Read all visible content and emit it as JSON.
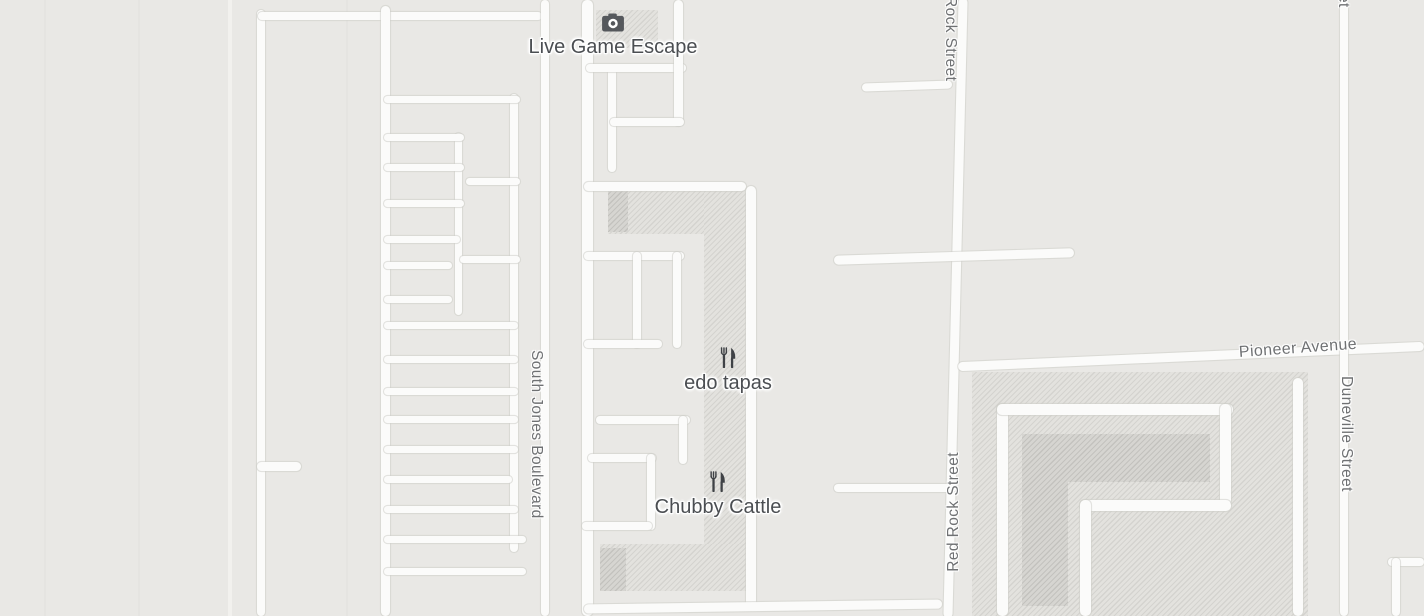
{
  "map": {
    "colors": {
      "background": "#e9e8e5",
      "road_fill": "#fbfbfa",
      "road_casing": "#cdcdc8",
      "hatch_base": "#e3e2de",
      "hatch_stripe": "#d4d3cf",
      "hatch_dark_base": "#d6d5d1",
      "hatch_dark_stripe": "#c3c2be",
      "poi_text": "#4b4e52",
      "street_text": "#6f7173",
      "icon_color": "#55585c"
    },
    "pois": [
      {
        "name": "Live Game Escape",
        "icon": "camera-icon"
      },
      {
        "name": "edo tapas",
        "icon": "restaurant-icon"
      },
      {
        "name": "Chubby Cattle",
        "icon": "restaurant-icon"
      }
    ],
    "street_labels": [
      {
        "text": "South Jones Boulevard"
      },
      {
        "text": "Rock Street"
      },
      {
        "text": "Red Rock Street"
      },
      {
        "text": "Pioneer Avenue"
      },
      {
        "text": "Duneville Street"
      },
      {
        "text": "et"
      }
    ],
    "areas": [
      {
        "x": 596,
        "y": 10,
        "w": 62,
        "h": 38,
        "cls": "hatch"
      },
      {
        "x": 608,
        "y": 188,
        "w": 140,
        "h": 46,
        "cls": "hatch"
      },
      {
        "x": 608,
        "y": 190,
        "w": 20,
        "h": 42,
        "cls": "hatch-dark"
      },
      {
        "x": 704,
        "y": 188,
        "w": 44,
        "h": 396,
        "cls": "hatch"
      },
      {
        "x": 600,
        "y": 544,
        "w": 148,
        "h": 47,
        "cls": "hatch"
      },
      {
        "x": 600,
        "y": 548,
        "w": 26,
        "h": 43,
        "cls": "hatch-dark"
      },
      {
        "x": 972,
        "y": 372,
        "w": 336,
        "h": 244,
        "cls": "hatch"
      },
      {
        "x": 1022,
        "y": 434,
        "w": 188,
        "h": 48,
        "cls": "hatch-dark"
      },
      {
        "x": 1022,
        "y": 434,
        "w": 46,
        "h": 172,
        "cls": "hatch-dark"
      }
    ],
    "roads": [
      {
        "x": 44,
        "y": 0,
        "w": 2,
        "h": 616,
        "cls": "faint2"
      },
      {
        "x": 138,
        "y": 0,
        "w": 2,
        "h": 616,
        "cls": "faint2"
      },
      {
        "x": 346,
        "y": 0,
        "w": 2,
        "h": 616,
        "cls": "faint2"
      },
      {
        "x": 228,
        "y": 0,
        "w": 4,
        "h": 616,
        "cls": "faint"
      },
      {
        "x": 257,
        "y": 10,
        "w": 8,
        "h": 606
      },
      {
        "x": 257,
        "y": 462,
        "w": 44,
        "h": 9
      },
      {
        "x": 258,
        "y": 12,
        "w": 284,
        "h": 8
      },
      {
        "x": 381,
        "y": 6,
        "w": 9,
        "h": 610
      },
      {
        "x": 510,
        "y": 94,
        "w": 8,
        "h": 458
      },
      {
        "x": 455,
        "y": 133,
        "w": 7,
        "h": 182
      },
      {
        "x": 384,
        "y": 96,
        "w": 136,
        "h": 7
      },
      {
        "x": 384,
        "y": 134,
        "w": 80,
        "h": 7
      },
      {
        "x": 384,
        "y": 164,
        "w": 80,
        "h": 7
      },
      {
        "x": 466,
        "y": 178,
        "w": 54,
        "h": 7
      },
      {
        "x": 384,
        "y": 200,
        "w": 80,
        "h": 7
      },
      {
        "x": 384,
        "y": 236,
        "w": 76,
        "h": 7
      },
      {
        "x": 460,
        "y": 256,
        "w": 60,
        "h": 7
      },
      {
        "x": 384,
        "y": 262,
        "w": 68,
        "h": 7
      },
      {
        "x": 384,
        "y": 296,
        "w": 68,
        "h": 7
      },
      {
        "x": 384,
        "y": 322,
        "w": 134,
        "h": 7
      },
      {
        "x": 384,
        "y": 356,
        "w": 134,
        "h": 7
      },
      {
        "x": 384,
        "y": 388,
        "w": 134,
        "h": 7
      },
      {
        "x": 384,
        "y": 416,
        "w": 134,
        "h": 7
      },
      {
        "x": 384,
        "y": 446,
        "w": 134,
        "h": 7
      },
      {
        "x": 384,
        "y": 476,
        "w": 128,
        "h": 7
      },
      {
        "x": 384,
        "y": 506,
        "w": 134,
        "h": 7
      },
      {
        "x": 384,
        "y": 536,
        "w": 142,
        "h": 7
      },
      {
        "x": 384,
        "y": 568,
        "w": 142,
        "h": 7
      },
      {
        "x": 541,
        "y": 0,
        "w": 8,
        "h": 616
      },
      {
        "x": 582,
        "y": 0,
        "w": 11,
        "h": 616
      },
      {
        "x": 608,
        "y": 66,
        "w": 8,
        "h": 106
      },
      {
        "x": 586,
        "y": 64,
        "w": 100,
        "h": 8
      },
      {
        "x": 674,
        "y": 0,
        "w": 9,
        "h": 126
      },
      {
        "x": 610,
        "y": 118,
        "w": 74,
        "h": 8
      },
      {
        "x": 584,
        "y": 182,
        "w": 162,
        "h": 9
      },
      {
        "x": 746,
        "y": 186,
        "w": 10,
        "h": 424
      },
      {
        "x": 584,
        "y": 252,
        "w": 100,
        "h": 8
      },
      {
        "x": 633,
        "y": 252,
        "w": 8,
        "h": 96
      },
      {
        "x": 673,
        "y": 252,
        "w": 8,
        "h": 96
      },
      {
        "x": 584,
        "y": 340,
        "w": 78,
        "h": 8
      },
      {
        "x": 596,
        "y": 416,
        "w": 94,
        "h": 8
      },
      {
        "x": 679,
        "y": 416,
        "w": 8,
        "h": 48
      },
      {
        "x": 588,
        "y": 454,
        "w": 68,
        "h": 8
      },
      {
        "x": 647,
        "y": 454,
        "w": 8,
        "h": 76
      },
      {
        "x": 582,
        "y": 522,
        "w": 70,
        "h": 8
      },
      {
        "x": 584,
        "y": 602,
        "w": 358,
        "h": 9,
        "rot": -0.8
      },
      {
        "x": 951,
        "y": -2,
        "w": 9,
        "h": 620,
        "rot": 1.4
      },
      {
        "x": 862,
        "y": 82,
        "w": 90,
        "h": 8,
        "rot": -2
      },
      {
        "x": 834,
        "y": 252,
        "w": 240,
        "h": 9,
        "rot": -1.8
      },
      {
        "x": 834,
        "y": 484,
        "w": 122,
        "h": 8
      },
      {
        "x": 958,
        "y": 352,
        "w": 466,
        "h": 9,
        "rot": -2.5
      },
      {
        "x": 1340,
        "y": 0,
        "w": 8,
        "h": 616
      },
      {
        "x": 997,
        "y": 404,
        "w": 11,
        "h": 212
      },
      {
        "x": 997,
        "y": 404,
        "w": 236,
        "h": 11
      },
      {
        "x": 1220,
        "y": 404,
        "w": 11,
        "h": 101
      },
      {
        "x": 1080,
        "y": 500,
        "w": 151,
        "h": 11
      },
      {
        "x": 1080,
        "y": 500,
        "w": 11,
        "h": 116
      },
      {
        "x": 1293,
        "y": 378,
        "w": 10,
        "h": 238
      },
      {
        "x": 1388,
        "y": 558,
        "w": 36,
        "h": 8
      },
      {
        "x": 1392,
        "y": 558,
        "w": 8,
        "h": 58
      }
    ]
  }
}
